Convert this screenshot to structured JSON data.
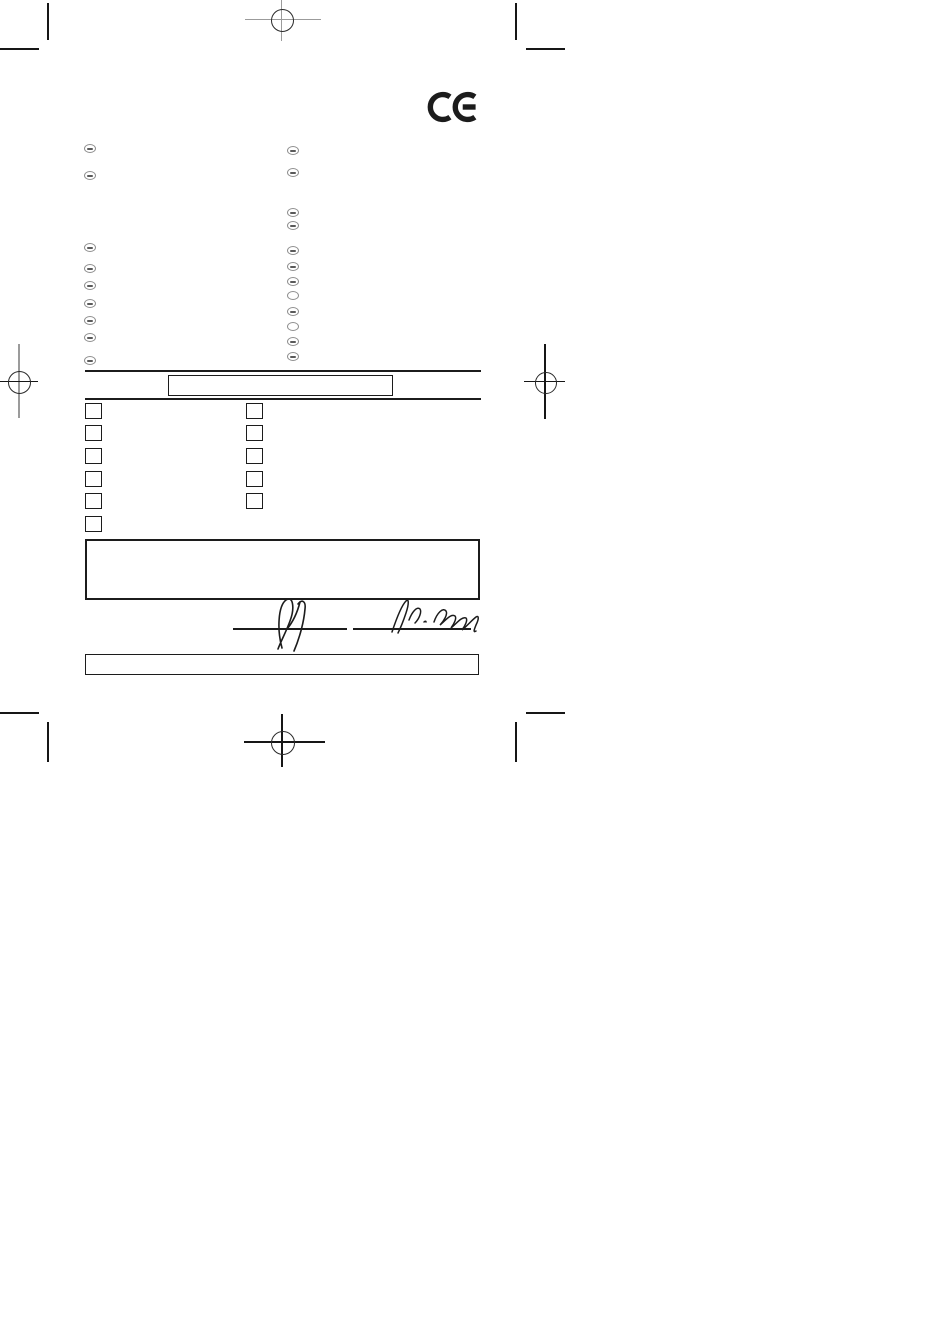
{
  "colors": {
    "paper": "#ffffff",
    "ink": "#1c1c1c",
    "guide_gray": "#9b9b9b",
    "badge_gray": "#8f8f8f"
  },
  "ce_mark": {
    "glyph": "CE"
  },
  "title_box": {
    "text": ""
  },
  "declaration_box": {
    "text": ""
  },
  "footer_box": {
    "text": ""
  },
  "language_badges": {
    "left_count": 9,
    "right_count": 12,
    "note_left": "",
    "note_right": ""
  },
  "checkbox_columns": {
    "left": [
      {
        "checked": false
      },
      {
        "checked": false
      },
      {
        "checked": false
      },
      {
        "checked": false
      },
      {
        "checked": false
      },
      {
        "checked": false
      }
    ],
    "right": [
      {
        "checked": false
      },
      {
        "checked": false
      },
      {
        "checked": false
      },
      {
        "checked": false
      },
      {
        "checked": false
      }
    ]
  },
  "signatures": {
    "left_text": "",
    "right_text": ""
  }
}
